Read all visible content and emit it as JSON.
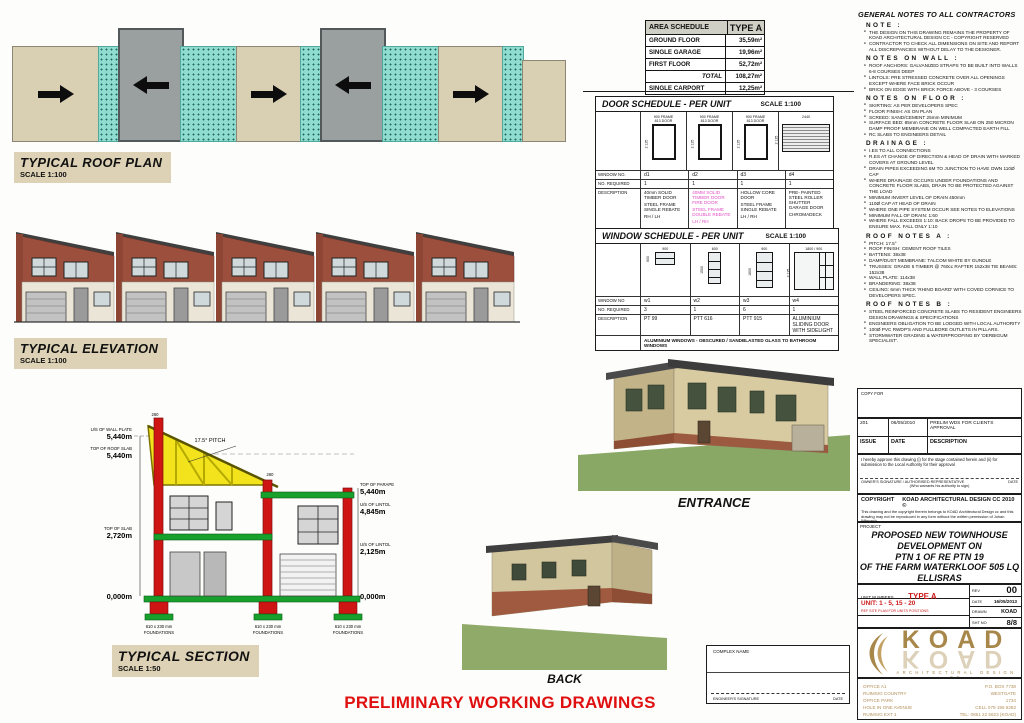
{
  "labels": {
    "roof_plan_title": "TYPICAL ROOF PLAN",
    "roof_plan_scale": "SCALE 1:100",
    "elevation_title": "TYPICAL ELEVATION",
    "elevation_scale": "SCALE 1:100",
    "section_title": "TYPICAL SECTION",
    "section_scale": "SCALE 1:50",
    "entrance": "ENTRANCE",
    "back": "BACK",
    "footer": "PRELIMINARY WORKING DRAWINGS"
  },
  "area_schedule": {
    "title": "AREA SCHEDULE",
    "type_header": "TYPE A",
    "rows": [
      {
        "label": "GROUND FLOOR",
        "value": "35,59m²"
      },
      {
        "label": "SINGLE GARAGE",
        "value": "19,96m²"
      },
      {
        "label": "FIRST FLOOR",
        "value": "52,72m²"
      },
      {
        "label": "TOTAL",
        "value": "108,27m²"
      },
      {
        "label": "SINGLE CARPORT",
        "value": "12,25m²"
      }
    ]
  },
  "door_schedule": {
    "title": "DOOR SCHEDULE - PER UNIT",
    "scale": "SCALE 1:100",
    "row_label_no": "WINDOW NO.",
    "row_label_required": "NO. REQUIRED",
    "row_label_description": "DESCRIPTION",
    "columns": [
      {
        "no": "d1",
        "required": "1",
        "frame_dim": "900 FRAME",
        "door_dim": "813 DOOR",
        "height_dim": "2 125",
        "lines": [
          "40mm SOLID TIMBER DOOR",
          "STEEL FRAME SINGLE REBATE",
          "RH / LH"
        ]
      },
      {
        "no": "d2",
        "required": "1",
        "frame_dim": "900 FRAME",
        "door_dim": "813 DOOR",
        "height_dim": "2 125",
        "lines": [
          "40MM SOLID TIMBER DOOR FIRE DOOR",
          "STEEL FRAME DOUBLE REBATE",
          "LH / RH"
        ]
      },
      {
        "no": "d3",
        "required": "1",
        "frame_dim": "900 FRAME",
        "door_dim": "813 DOOR",
        "height_dim": "2 125",
        "lines": [
          "HOLLOW CORE DOOR",
          "STEEL FRAME SINGLE REBATE",
          "LH / RH"
        ]
      },
      {
        "no": "d4",
        "required": "1",
        "frame_dim": "2440",
        "door_dim": "",
        "height_dim": "2 125",
        "lines": [
          "PRE- PAINTED STEEL ROLLER SHUTTER GARAGE DOOR",
          "CHROMADECK",
          ""
        ]
      }
    ]
  },
  "window_schedule": {
    "title": "WINDOW SCHEDULE - PER UNIT",
    "scale": "SCALE 1:100",
    "row_label_no": "WINDOW NO",
    "row_label_required": "NO. REQUIRED",
    "row_label_description": "DESCRIPTION",
    "columns": [
      {
        "no": "w1",
        "required": "3",
        "width_dim": "900",
        "height_dim": "600",
        "description": "PT 99"
      },
      {
        "no": "w2",
        "required": "1",
        "width_dim": "600",
        "height_dim": "1500",
        "description": "PTT 616"
      },
      {
        "no": "w3",
        "required": "6",
        "width_dim": "900",
        "height_dim": "1800",
        "description": "PTT 915"
      },
      {
        "no": "w4",
        "required": "1",
        "width_dim": "1800 / 900",
        "height_dim": "2 125",
        "description": "ALUMINIUM SLIDING DOOR WITH SIDELIGHT"
      }
    ],
    "note": "ALUMINIUM WINDOWS - OBSCURED / SANDBLASTED GLASS TO BATHROOM WINDOWS"
  },
  "section_drawing": {
    "pitch": "17.5° PITCH",
    "parapet_dim": "260",
    "levels_left": [
      {
        "name": "U/S OF WALL PLATE",
        "value": "5,440m"
      },
      {
        "name": "TOP OF ROOF SLAB",
        "value": "5,440m"
      },
      {
        "name": "TOP OF  SLAB",
        "value": "2,720m"
      },
      {
        "name": "",
        "value": "0,000m"
      }
    ],
    "levels_right": [
      {
        "name": "TOP OF  PARAPET",
        "value": "5,440m"
      },
      {
        "name": "U/S OF LINTOL",
        "value": "4,845m"
      },
      {
        "name": "U/S OF LINTOL",
        "value": "2,125m"
      },
      {
        "name": "",
        "value": "0,000m"
      }
    ],
    "foundation_line1": "610 x 230 mm",
    "foundation_line2": "FOUNDATIONS"
  },
  "general_notes": {
    "heading": "GENERAL NOTES TO ALL CONTRACTORS",
    "sections": [
      {
        "title": "NOTE :",
        "items": [
          "THE DESIGN ON THIS DRAWING REMAINS THE PROPERTY OF KOAD ARCHITECTURAL DESIGN CC - COPYRIGHT RESERVED",
          "CONTRACTOR TO CHECK ALL DIMENSIONS ON SITE AND REPORT ALL DISCREPANCIES WITHOUT DELAY TO THE DESIGNER."
        ]
      },
      {
        "title": "NOTES ON WALL :",
        "items": [
          "ROOF ANCHORS: GALVANIZED STRAPS TO BE BUILT INTO WALLS 6-8 COURSES DEEP",
          "LINTOLS: PRE STRESSED CONCRETE OVER ALL OPENINGS EXCEPT WHERE FACE BRICK OCCUR",
          "BRICK ON EDGE WITH BRICK FORCE ABOVE - 3 COURSES"
        ]
      },
      {
        "title": "NOTES ON FLOOR :",
        "items": [
          "SKIRTING: AS PER DEVELOPERS SPEC",
          "FLOOR FINISH: AS ON PLAN",
          "SCREED: SAND/CEMENT 25mm MINIMUM",
          "SURFACE BED: 85mm CONCRETE FLOOR SLAB ON 250 MICRON DAMP PROOF MEMBRANE ON WELL COMPACTED EARTH FILL",
          "RC SLABS TO ENGINEERS DETAIL"
        ]
      },
      {
        "title": "DRAINAGE :",
        "items": [
          "I.ES TO ALL CONNECTIONS",
          "R.ES AT CHANGE OF DIRECTION & HEAD OF DRAIN WITH MARKED COVERS AT GROUND LEVEL",
          "DRAIN PIPES EXCEEDING 6M TO JUNCTION TO HAVE OWN 110Ø CAP",
          "WHERE DRAINAGE OCCURS UNDER FOUNDATIONS AND CONCRETE FLOOR SLABS, DRAIN TO BE PROTECTED AGAINST THE LOAD",
          "MINIMUM INVERT LEVEL OF DRAIN 450mm",
          "110Ø CAP AT HEAD OF DRAIN",
          "WHERE ONE PIPE SYSTEM OCCUR SEE NOTES TO ELEVATIONS",
          "MINIMUM FALL OF DRAIN: 1:60",
          "WHERE FALL EXCEEDS 1:10: BACK DROPS TO BE PROVIDED TO ENSURE MAX. FALL ONLY 1:10"
        ]
      },
      {
        "title": "ROOF NOTES A :",
        "items": [
          "PITCH: 17.5°",
          "ROOF FINISH: CEMENT ROOF TILES",
          "BATTENS: 38x38",
          "DAMP/DUST MEMBRANE: TALCOM WHITE BY GUNDLE",
          "TRUSSES: GRADE 5 TIMBER @ 760cc  RAFTER 152x38  TIE BEAMS: 152x38",
          "WALL PLATE: 114x38",
          "BRANDERING: 38x38",
          "CEILING: 6mm THICK 'RHINO BOARD' WITH COVED CORNICE TO DEVELOPERS SPEC."
        ]
      },
      {
        "title": "ROOF NOTES B :",
        "items": [
          "STEEL REINFORCED CONCRETE SLABS TO RESIDENT ENGINEERS DESIGN DRAWINGS & SPECIFICATIONS",
          "ENGINEERS OBLIGATION TO BE LODGED WITH LOCAL AUTHORITY",
          "100Ø PVC RWDP'S AND FULLBORE OUTLETS IN PILLARS.",
          "STORMWATER GRADING & WATERPROOFING BY 'DERBIGUM SPECIALIST'."
        ]
      }
    ]
  },
  "title_block": {
    "copy_for": "COPY FOR",
    "issue_row": {
      "issue": "201",
      "date": "06/05/2010",
      "description": "PRELIM WDS FOR CLIENTS APPROVAL"
    },
    "issue_header": {
      "issue": "ISSUE",
      "date": "DATE",
      "description": "DESCRIPTION"
    },
    "approval_text": "I hereby approve this drawing (i) for the stage contained herein and (ii) for submission to the Local Authority for their approval",
    "owner_signature_label": "OWNER'S SIGNATURE / AUTHORISED REPRESENTATIVE",
    "owner_date_label": "DATE",
    "warrant_note": "(Who warrants his authority to sign)",
    "copyright_label": "COPYRIGHT",
    "copyright_firm": "KOAD ARCHITECTURAL DESIGN CC 2010 ©",
    "copyright_body": "This drawing and the copyright therein belongs to KOAD Architectural Design cc and this drawing may not be reproduced in any form without the written permission of Johan Wilsnach.",
    "project_label": "PROJECT",
    "project_lines": [
      "PROPOSED NEW TOWNHOUSE",
      "DEVELOPMENT ON",
      "PTN 1 OF RE PTN 19",
      "OF THE FARM WATERKLOOF 505 LQ",
      "ELLISRAS"
    ],
    "for_label": "FOR",
    "client": "VISION DIRECT 196 CC",
    "unit_numbers_label": "UNIT NUMBERS",
    "unit_type": "TYPE A",
    "unit_range": "UNIT: 1 - 5, 15 - 20",
    "site_note": "REF SITE PLAN FOR UNITS POSITIONS",
    "rev_label": "REV",
    "rev": "00",
    "date_label": "DATE",
    "date": "16/05/2013",
    "drawn_label": "DRAWN",
    "drawn": "KOAD",
    "drawing_no_label": "DRAWING NUMBER",
    "drawing_no": "9101/T/ELLISRAS/PWD/08",
    "sheet_label": "SHT NO",
    "sheet": "8/8",
    "logo_text": "KOAD",
    "logo_sub": "ARCHITECTURAL DESIGN CC",
    "address_left": [
      "OFFICE A1",
      "RUIMSIG COUNTRY",
      "OFFICE PARK",
      "HOLE IN ONE AVENUE",
      "RUIMSIG EXT 1"
    ],
    "address_right": [
      "P.O. BOX 7738",
      "WESTGATE",
      "1734",
      "CELL 079 195 5282",
      "TEL: 0861 22 5623 (KOAD)"
    ]
  },
  "complex_box": {
    "title": "COMPLEX NAME",
    "signature_label": "ENGINEER'S SIGNATURE",
    "date_label": "DATE"
  },
  "colors": {
    "accent_red": "#cc1a1a",
    "footer_red": "#e01010",
    "truss_yellow": "#f2e31c",
    "slab_green": "#17a02c",
    "teal_roof": "#8fdcd0",
    "tan_label": "#ddd2b5",
    "brick": "#9c4f3c",
    "logo_gold": "#a8874b",
    "magenta_text": "#e14fc4"
  }
}
